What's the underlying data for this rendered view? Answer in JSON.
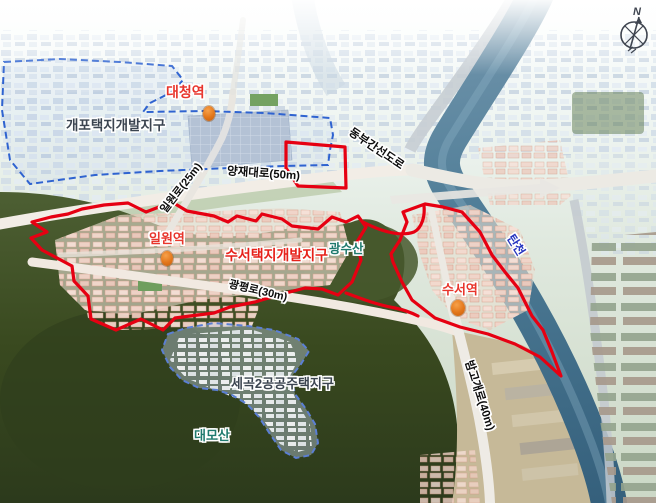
{
  "districts": {
    "gaepo": {
      "label": "개포택지개발지구"
    },
    "suseo": {
      "label": "수서택지개발지구"
    },
    "segok2": {
      "label": "세곡2공공주택지구"
    }
  },
  "stations": {
    "daecheong": {
      "label": "대청역"
    },
    "irwon": {
      "label": "일원역"
    },
    "suseo": {
      "label": "수서역"
    }
  },
  "roads": {
    "yangjae": {
      "label": "양재대로(50m)"
    },
    "irwon_ro": {
      "label": "일원로(25m)"
    },
    "dongbu_expressway": {
      "label": "동부간선도로"
    },
    "gwangpyeong": {
      "label": "광평로(30m)"
    },
    "bamgogae": {
      "label": "밤고개로(40m)"
    }
  },
  "features": {
    "gwangsusan": {
      "label": "광수산"
    },
    "daemosan": {
      "label": "대모산"
    },
    "tancheon": {
      "label": "탄천"
    }
  },
  "compass": {
    "north_label": "N"
  },
  "colors": {
    "district_boundary_red": "#e60012",
    "district_boundary_blue": "#2f63d0",
    "station_marker_orange": "#e2761a",
    "mountain_label_teal": "#1f7a6e",
    "river_label_blue": "#2433c0",
    "road_label_black": "#0d0d0d"
  }
}
